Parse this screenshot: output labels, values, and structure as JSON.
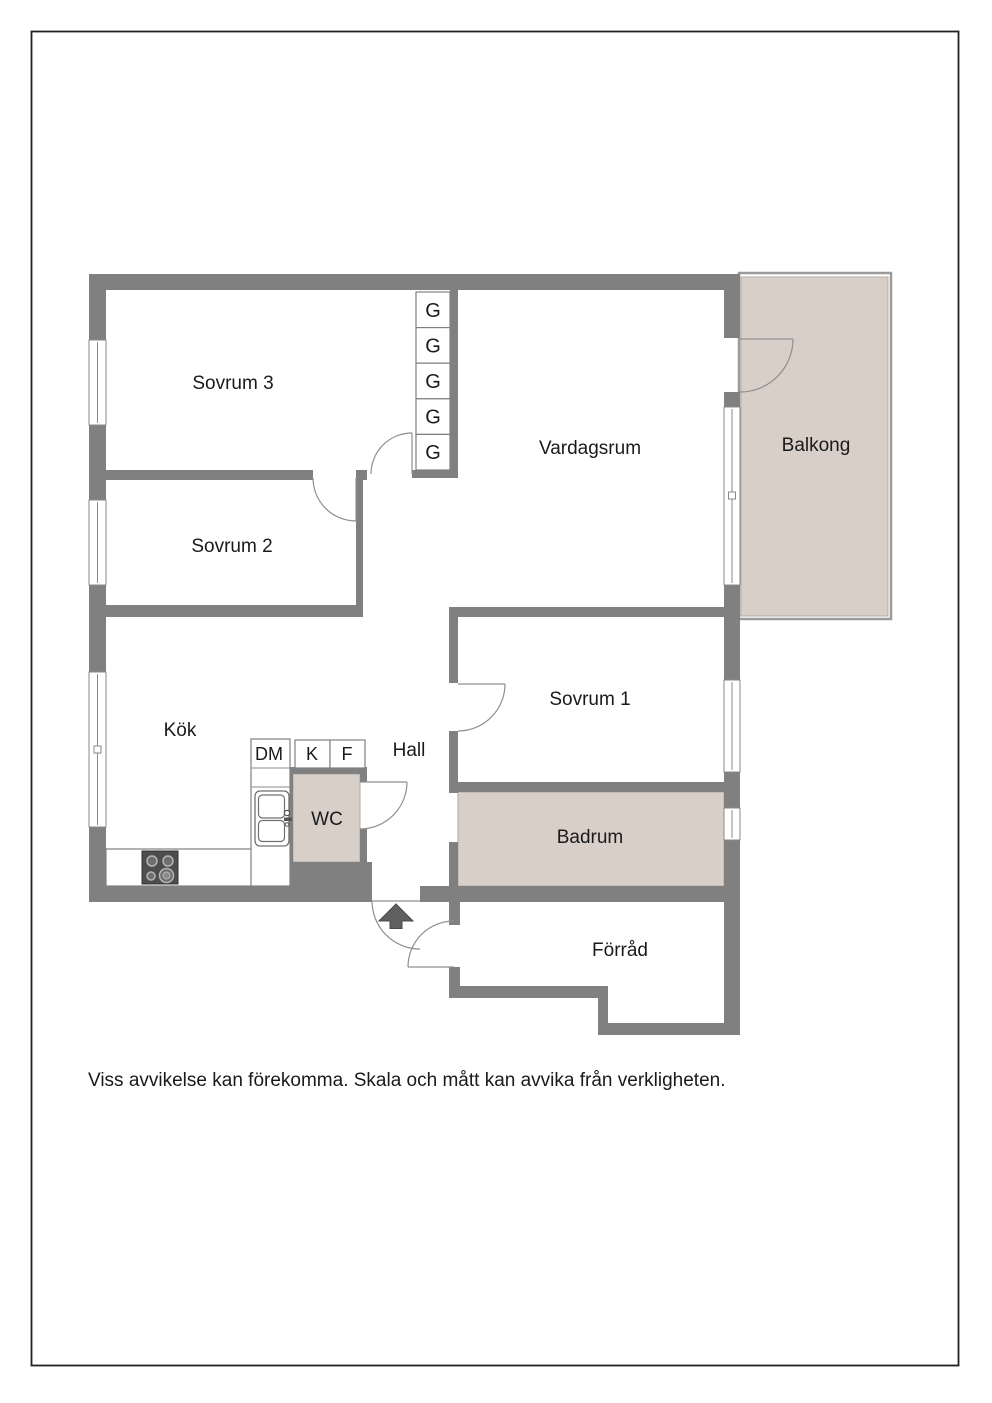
{
  "page": {
    "disclaimer": "Viss avvikelse kan förekomma. Skala och mått kan avvika från verkligheten."
  },
  "rooms": {
    "sovrum3": "Sovrum 3",
    "sovrum2": "Sovrum 2",
    "sovrum1": "Sovrum 1",
    "vardagsrum": "Vardagsrum",
    "balkong": "Balkong",
    "kok": "Kök",
    "hall": "Hall",
    "wc": "WC",
    "badrum": "Badrum",
    "forrad": "Förråd"
  },
  "fixtures": {
    "wardrobe": "G",
    "dishwasher": "DM",
    "fridge": "K",
    "freezer": "F"
  },
  "colors": {
    "wall": "#808080",
    "room_fill": "#d8d0c8",
    "dark_fixture": "#5f5f5f",
    "railing": "#9a9a9a"
  }
}
